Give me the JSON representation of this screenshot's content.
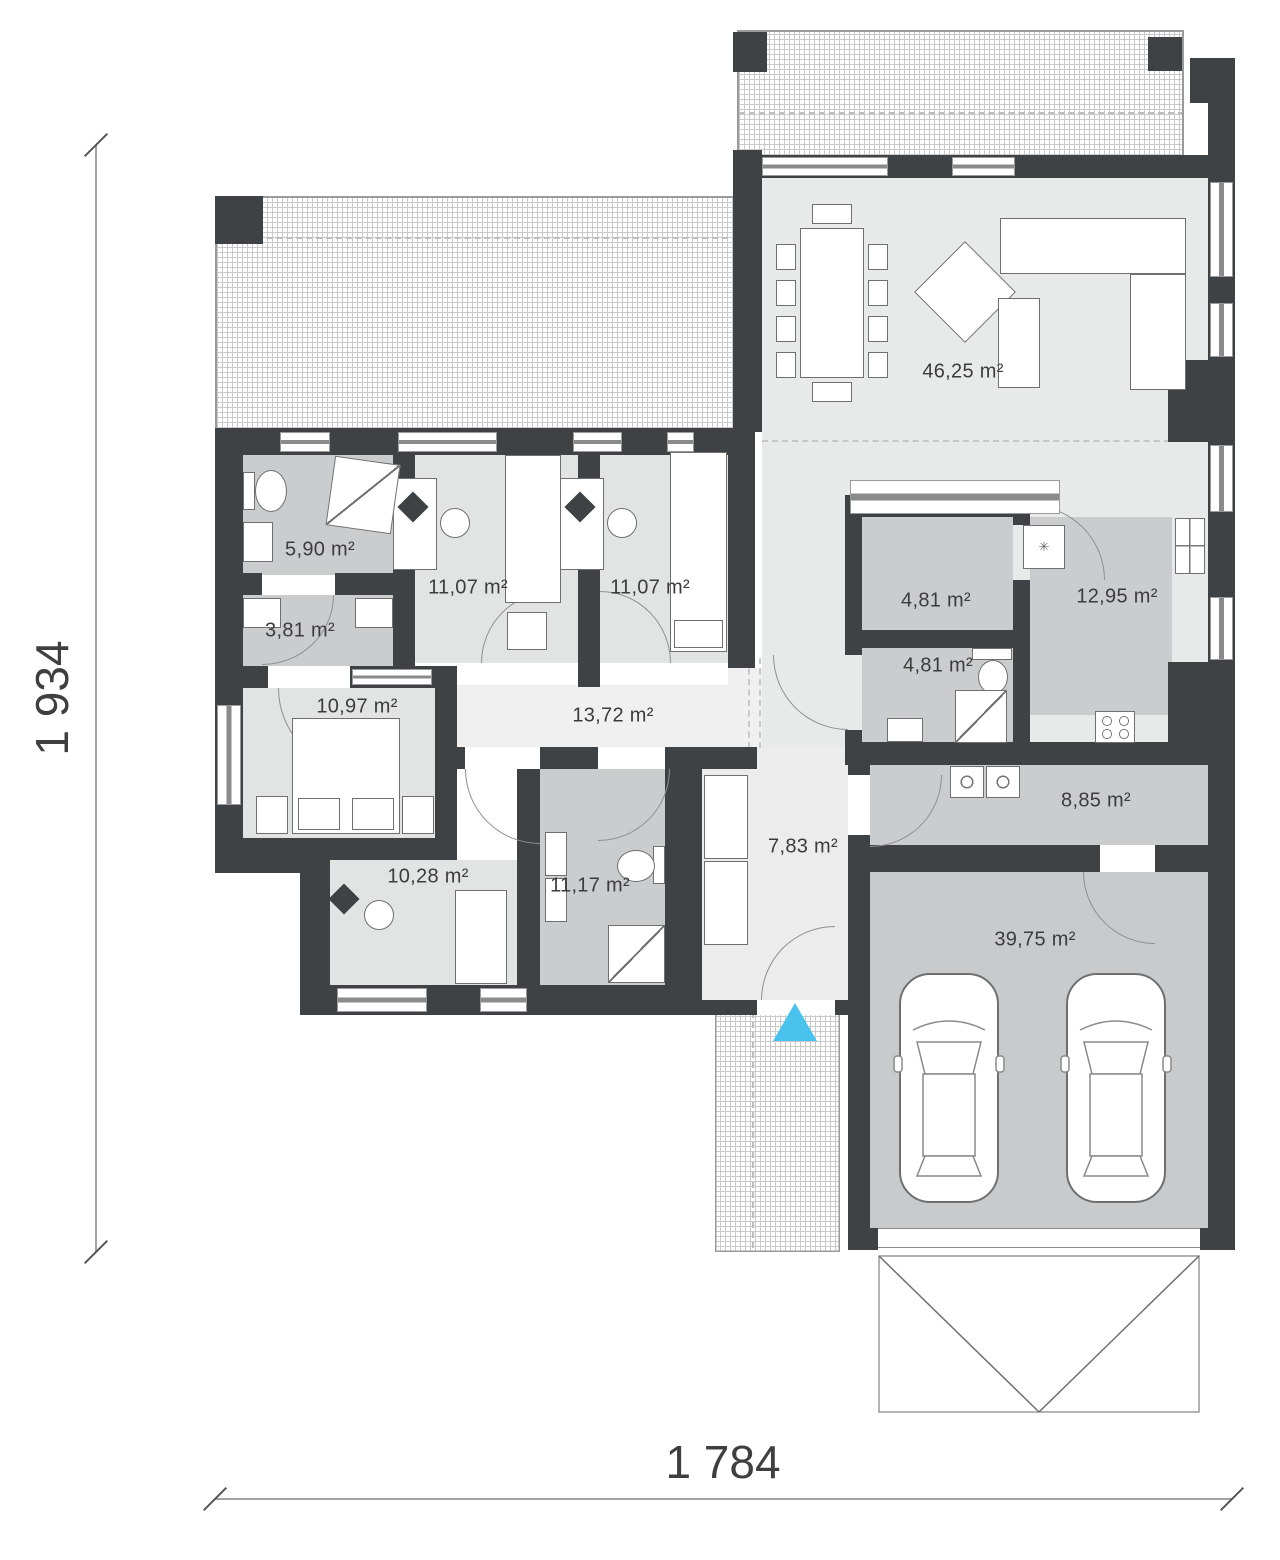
{
  "title": "single-storey house floor plan",
  "dimensions": {
    "height_label": "1 934",
    "width_label": "1 784"
  },
  "rooms": [
    {
      "id": "living-room",
      "area": "46,25 m²"
    },
    {
      "id": "bathroom-1",
      "area": "5,90 m²"
    },
    {
      "id": "closet",
      "area": "3,81 m²"
    },
    {
      "id": "bedroom-1",
      "area": "11,07 m²"
    },
    {
      "id": "bedroom-2",
      "area": "11,07 m²"
    },
    {
      "id": "bedroom-3",
      "area": "10,97 m²"
    },
    {
      "id": "hallway",
      "area": "13,72 m²"
    },
    {
      "id": "bedroom-4",
      "area": "10,28 m²"
    },
    {
      "id": "bathroom-2",
      "area": "11,17 m²"
    },
    {
      "id": "entry-hall",
      "area": "7,83 m²"
    },
    {
      "id": "pantry",
      "area": "4,81 m²"
    },
    {
      "id": "bathroom-3",
      "area": "4,81 m²"
    },
    {
      "id": "kitchen",
      "area": "12,95 m²"
    },
    {
      "id": "utility-room",
      "area": "8,85 m²"
    },
    {
      "id": "garage",
      "area": "39,75 m²"
    }
  ],
  "icons": {
    "star_symbol": "✳",
    "entrance_marker": "cyan-triangle-up"
  },
  "colors": {
    "wall": "#3F4245",
    "floor_light": "#E4E5E5",
    "floor_medium": "#CBCCCD",
    "corridor": "#F0F0F0",
    "entrance_accent": "#49C3EE",
    "dimension_text": "#3F3F3F"
  }
}
